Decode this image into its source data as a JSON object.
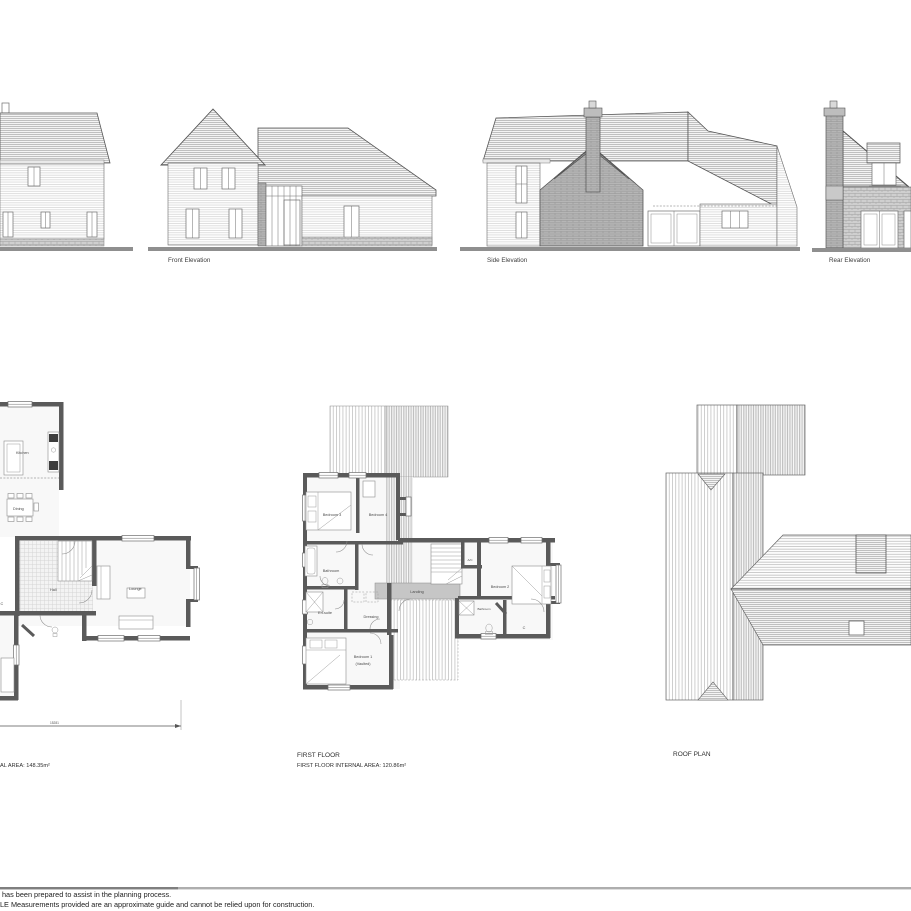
{
  "elevations": {
    "front": "Front Elevation",
    "side": "Side Elevation",
    "rear": "Rear Elevation"
  },
  "ground_floor": {
    "room_kitchen": "Kitchen",
    "room_dining": "Dining",
    "room_hall": "Hall",
    "room_lounge": "Lounge",
    "room_c": "C",
    "dimension": "15281",
    "area_text": "AL AREA: 148.35m²"
  },
  "first_floor": {
    "title": "FIRST FLOOR",
    "area_text": "FIRST FLOOR INTERNAL AREA: 120.86m²",
    "room_bedroom3": "Bedroom 3",
    "room_bedroom4": "Bedroom 4",
    "room_bathroom": "Bathroom",
    "room_ensuite": "En-suite",
    "room_dressing": "Dressing",
    "room_landing": "Landing",
    "room_ac": "A/C",
    "room_bedroom2": "Bedroom 2",
    "room_bathroom2": "Bathroom",
    "room_c": "C",
    "room_bedroom1": "Bedroom 1",
    "room_bedroom1_sub": "(Vaulted)"
  },
  "roof_plan": {
    "title": "ROOF PLAN"
  },
  "footer": {
    "line1": "has been prepared to assist in the planning process.",
    "line2": "LE Measurements provided are an approximate guide and cannot be relied upon for construction."
  }
}
